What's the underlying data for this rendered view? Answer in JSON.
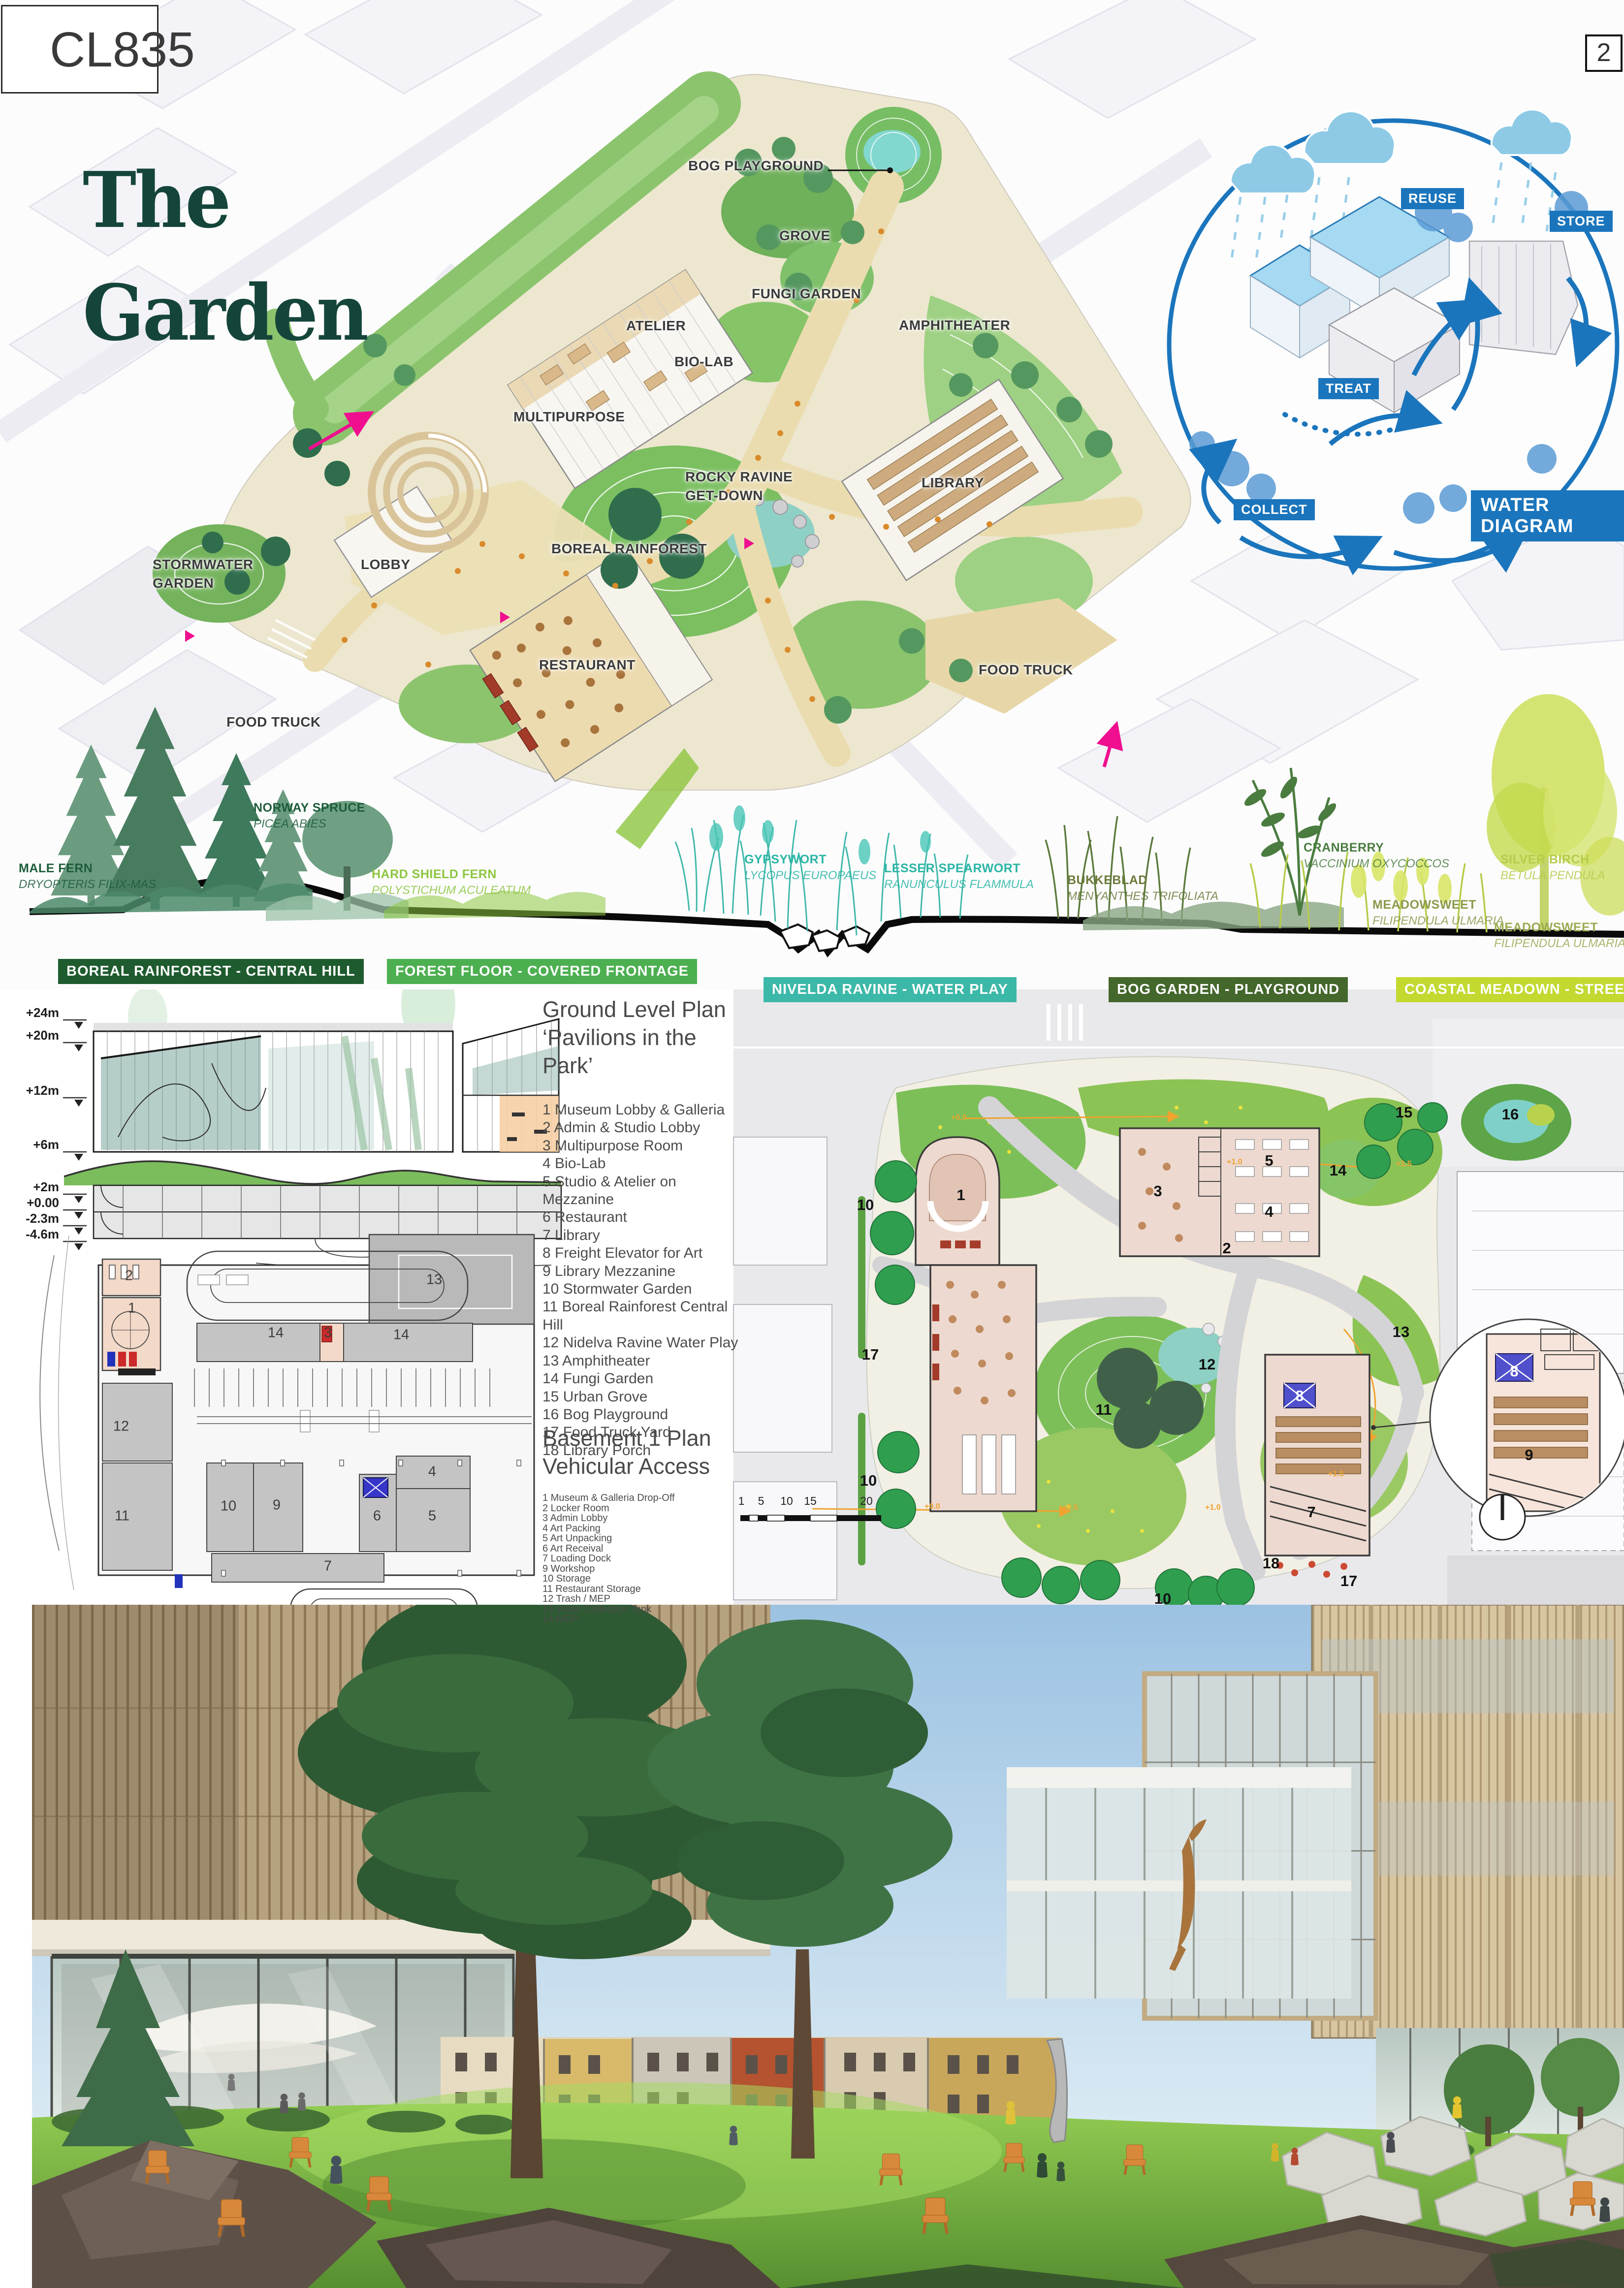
{
  "board": {
    "code": "CL835",
    "page": "2",
    "title": "The\nGarden"
  },
  "site_plan": {
    "labels": [
      "BOG PLAYGROUND",
      "GROVE",
      "FUNGI GARDEN",
      "ATELIER",
      "BIO-LAB",
      "AMPHITHEATER",
      "MULTIPURPOSE",
      "ROCKY RAVINE\nGET-DOWN",
      "LIBRARY",
      "BOREAL RAINFOREST",
      "LOBBY",
      "STORMWATER\nGARDEN",
      "RESTAURANT",
      "FOOD TRUCK",
      "FOOD TRUCK"
    ]
  },
  "water_diagram": {
    "title": "WATER DIAGRAM",
    "labels": [
      "REUSE",
      "STORE",
      "TREAT",
      "COLLECT"
    ],
    "accent_blue": "#1b75bc"
  },
  "species": [
    {
      "name": "MALE FERN",
      "latin": "DRYOPTERIS FILIX-MAS",
      "color": "#1d5c3a"
    },
    {
      "name": "NORWAY SPRUCE",
      "latin": "PICEA ABIES",
      "color": "#1d5c3a"
    },
    {
      "name": "HARD SHIELD FERN",
      "latin": "POLYSTICHUM ACULEATUM",
      "color": "#8dc63f"
    },
    {
      "name": "GYPSYWORT",
      "latin": "LYCOPUS EUROPAEUS",
      "color": "#2ab5a5"
    },
    {
      "name": "LESSER SPEARWORT",
      "latin": "RANUNCULUS FLAMMULA",
      "color": "#2ab5a5"
    },
    {
      "name": "BUKKEBLAD",
      "latin": "MENYANTHES TRIFOLIATA",
      "color": "#6b7a3a"
    },
    {
      "name": "CRANBERRY",
      "latin": "VACCINIUM OXYCOCCOS",
      "color": "#4a7c3f"
    },
    {
      "name": "MEADOWSWEET",
      "latin": "FILIPENDULA ULMARIA",
      "color": "#8a9a4a"
    },
    {
      "name": "SILVER BIRCH",
      "latin": "BETULA PENDULA",
      "color": "#b5cc4a"
    },
    {
      "name": "MEADOWSWEET",
      "latin": "FILIPENDULA ULMARIA",
      "color": "#9aab52"
    }
  ],
  "zone_bars": [
    {
      "label": "BOREAL RAINFOREST - CENTRAL HILL",
      "color": "#1e5b2e"
    },
    {
      "label": "FOREST FLOOR - COVERED FRONTAGE",
      "color": "#4caf50"
    },
    {
      "label": "NIVELDA RAVINE - WATER PLAY",
      "color": "#3cb8a8"
    },
    {
      "label": "BOG GARDEN - PLAYGROUND",
      "color": "#44672c"
    },
    {
      "label": "COASTAL MEADOWN - STREETSCAPE",
      "color": "#c3d930"
    }
  ],
  "section": {
    "elevations": [
      "+24m",
      "+20m",
      "+12m",
      "+6m",
      "+2m",
      "+0.00",
      "-2.3m",
      "-4.6m"
    ]
  },
  "legend": {
    "ground_title": "Ground Level Plan",
    "ground_subtitle": "‘Pavilions in the Park’",
    "ground_items": [
      "1 Museum Lobby & Galleria",
      "2 Admin & Studio Lobby",
      "3 Multipurpose Room",
      "4 Bio-Lab",
      "5 Studio & Atelier on Mezzanine",
      "6 Restaurant",
      "7 Library",
      "8 Freight Elevator for Art",
      "9 Library Mezzanine",
      "10 Stormwater Garden",
      "11 Boreal Rainforest Central Hill",
      "12 Nidelva Ravine Water Play",
      "13 Amphitheater",
      "14 Fungi Garden",
      "15 Urban Grove",
      "16 Bog Playground",
      "17 Food Truck Yard",
      "18 Library Porch"
    ],
    "basement_title": "Basement 1 Plan",
    "basement_subtitle": "Vehicular Access",
    "basement_items": [
      "1  Museum & Galleria Drop-Off",
      "2 Locker Room",
      "3 Admin Lobby",
      "4 Art Packing",
      "5 Art Unpacking",
      "6 Art Receival",
      "7 Loading Dock",
      "9 Workshop",
      "10 Storage",
      "11 Restaurant Storage",
      "12 Trash / MEP",
      "13 Water Collection Tank",
      "14 MEP"
    ]
  },
  "ground_plan": {
    "numbers": [
      "1",
      "10",
      "3",
      "2",
      "5",
      "4",
      "14",
      "15",
      "16",
      "17",
      "11",
      "12",
      "13",
      "8",
      "10",
      "7",
      "18",
      "17",
      "10",
      "8",
      "9"
    ],
    "scale_labels": [
      "1",
      "5",
      "10",
      "15",
      "20"
    ],
    "spot_elevations": [
      "+0.0",
      "+1.0",
      "+1.5",
      "+1.5",
      "+0.0",
      "+0.5",
      "+1.0"
    ]
  },
  "basement_plan": {
    "numbers": [
      "2",
      "1",
      "14",
      "3",
      "14",
      "13",
      "12",
      "11",
      "10",
      "9",
      "7",
      "6",
      "5",
      "4"
    ]
  }
}
